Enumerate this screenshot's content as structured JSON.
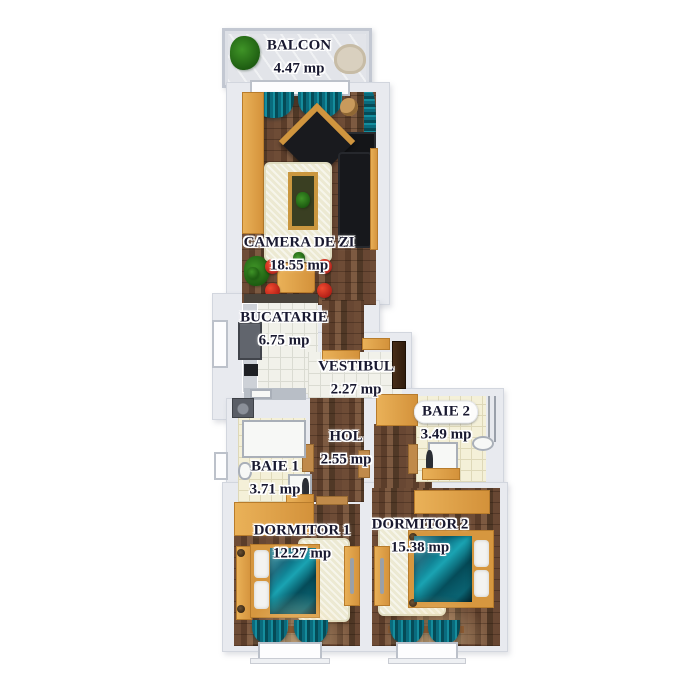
{
  "image_type": "apartment-floor-plan-render",
  "area_unit": "mp",
  "rooms": [
    {
      "name": "BALCON",
      "area": "4.47 mp"
    },
    {
      "name": "CAMERA DE ZI",
      "area": "18.55 mp"
    },
    {
      "name": "BUCATARIE",
      "area": "6.75 mp"
    },
    {
      "name": "VESTIBUL",
      "area": "2.27 mp"
    },
    {
      "name": "HOL",
      "area": "2.55 mp"
    },
    {
      "name": "BAIE 1",
      "area": "3.71 mp"
    },
    {
      "name": "BAIE 2",
      "area": "3.49 mp"
    },
    {
      "name": "DORMITOR 1",
      "area": "12.27 mp"
    },
    {
      "name": "DORMITOR 2",
      "area": "15.38 mp"
    }
  ],
  "colors": {
    "wall": "#e8eaef",
    "wood_floor": "#5b3d2a",
    "tile_white": "#f1f1ea",
    "tile_cream": "#f4f0d8",
    "accent_orange": "#d3913a",
    "textile_teal": "#0a6b7d",
    "rug_cream": "#ece9d2",
    "chair_red": "#c41e1e",
    "label_text": "#191930",
    "background": "#ffffff"
  }
}
